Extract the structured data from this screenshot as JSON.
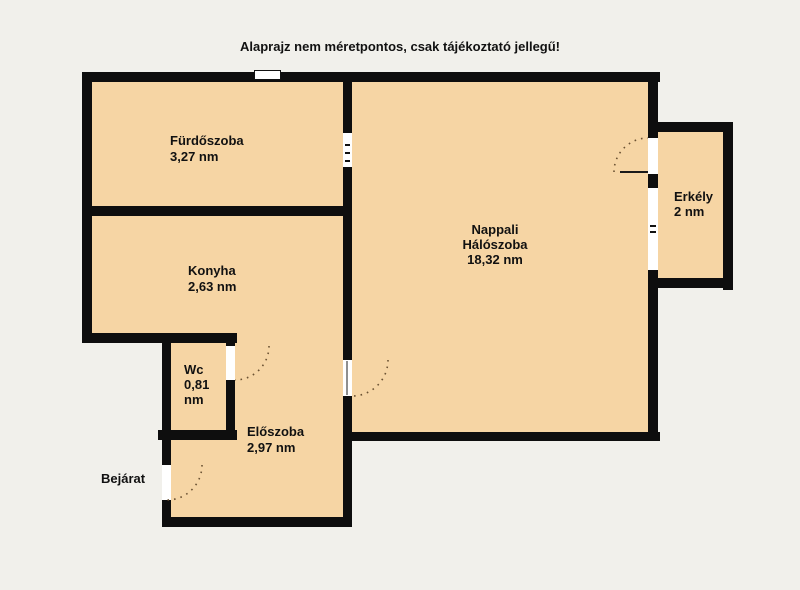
{
  "disclaimer": "Alaprajz nem méretpontos, csak tájékoztató jellegű!",
  "rooms": {
    "furdoszoba": {
      "name": "Fürdőszoba",
      "area": "3,27 nm"
    },
    "konyha": {
      "name": "Konyha",
      "area": "2,63 nm"
    },
    "wc": {
      "name": "Wc",
      "area": "0,81 nm"
    },
    "eloszoba": {
      "name": "Előszoba",
      "area": "2,97 nm"
    },
    "nappali": {
      "name_line1": "Nappali",
      "name_line2": "Hálószoba",
      "area": "18,32 nm"
    },
    "erkely": {
      "name": "Erkély",
      "area": "2 nm"
    }
  },
  "labels": {
    "entrance": "Bejárat"
  },
  "colors": {
    "background": "#F1F0EB",
    "room_fill": "#F6D5A4",
    "wall": "#0E0E0E",
    "door_arc": "#6B5233"
  }
}
